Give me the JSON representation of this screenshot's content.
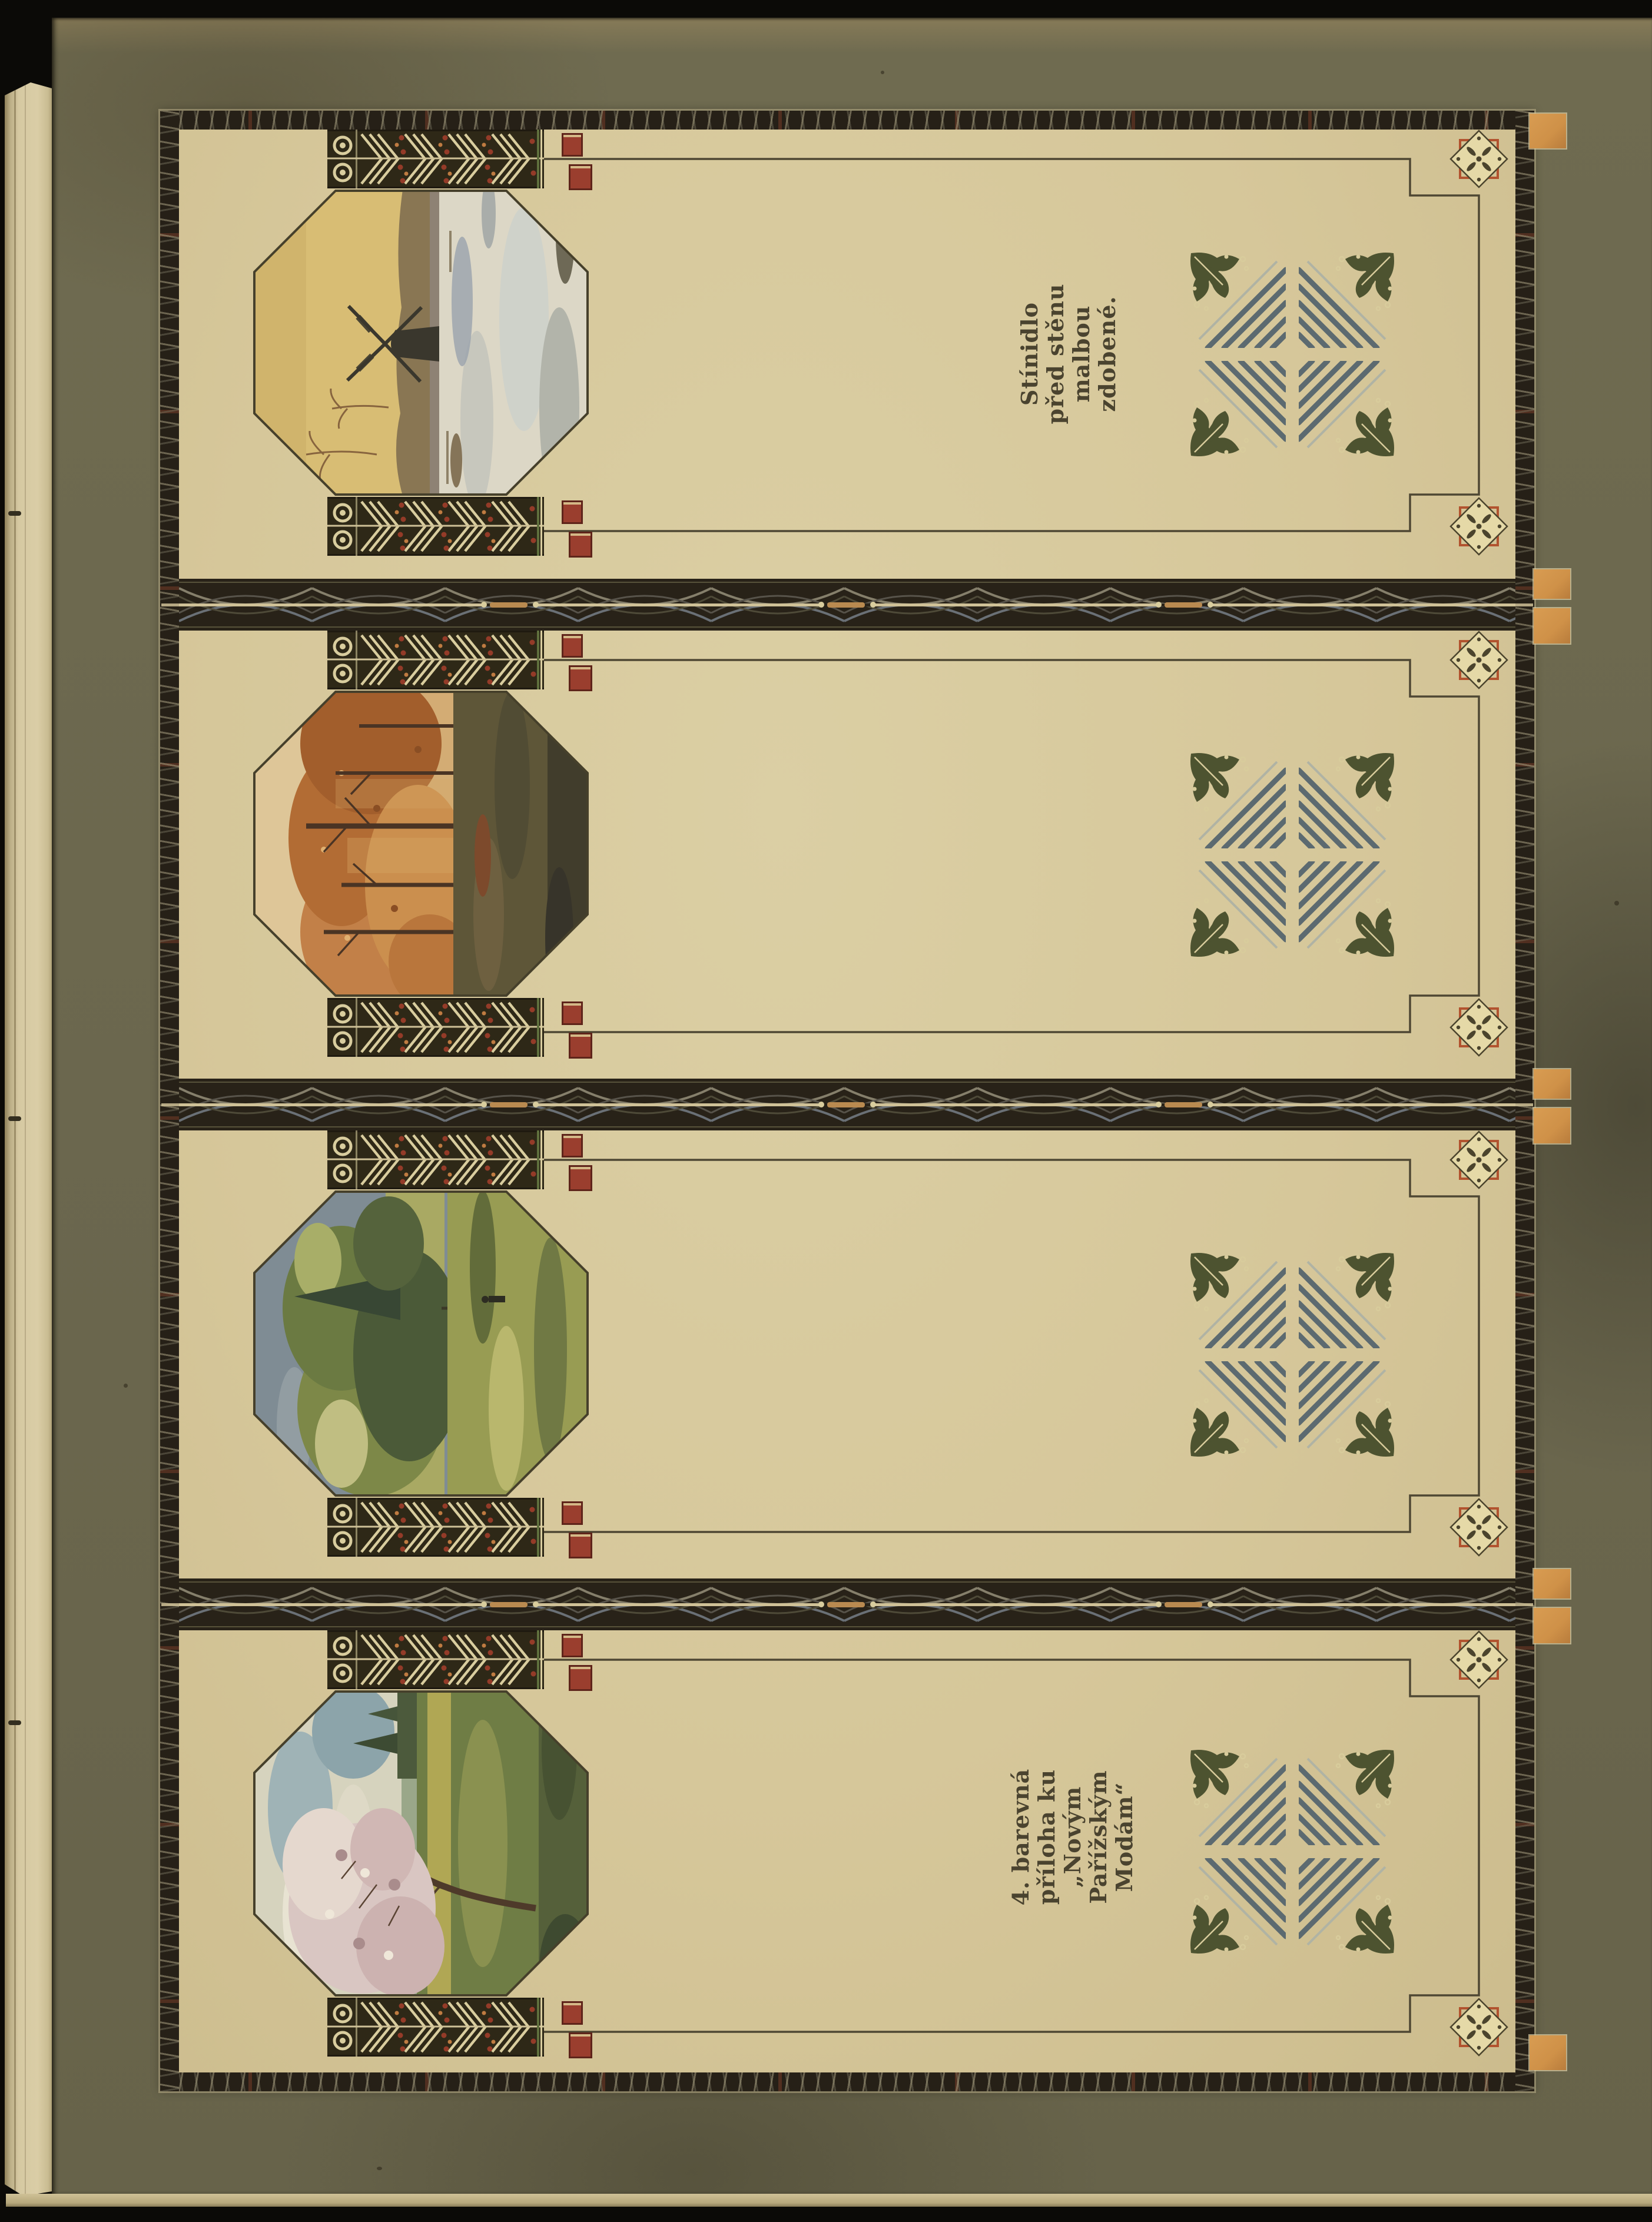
{
  "page": {
    "kind": "scanned-book-plate",
    "captions": {
      "shade": {
        "lines": [
          "Stínidlo",
          "před stěnu",
          "malbou",
          "zdobené."
        ]
      },
      "supplement": {
        "lines": [
          "4. barevná",
          "příloha ku",
          "„Novým",
          "Pařížským",
          "Modám“"
        ]
      }
    },
    "panels": [
      {
        "scene": "windmill-winter-landscape"
      },
      {
        "scene": "autumn-forest-landscape"
      },
      {
        "scene": "summer-trees-landscape"
      },
      {
        "scene": "spring-blossom-landscape"
      }
    ],
    "colors": {
      "paper": "#d6c79c",
      "olive": "#6b674e",
      "frame": "#262017",
      "accent_red": "#9a3e2e",
      "accent_orange": "#d0914c",
      "ornament_green": "#4d5330",
      "stripe_blue": "#5c6a70",
      "rule": "#4e4733",
      "cream_ornament": "#d9cd9e",
      "ink": "#4a432f"
    }
  }
}
